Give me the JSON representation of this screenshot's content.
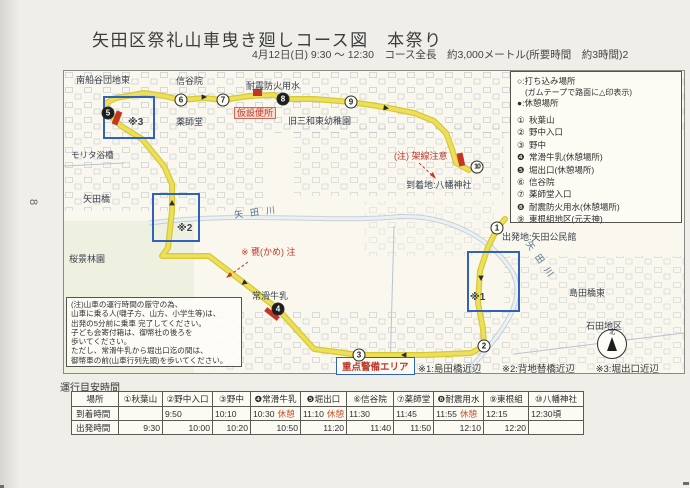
{
  "page": {
    "side_number": "8"
  },
  "header": {
    "title": "矢田区祭礼山車曳き廻しコース図　本祭り",
    "subtitle": "4月12日(日) 9:30 ～ 12:30　コース全長　約3,000メートル(所要時間　約3時間)2"
  },
  "legend": {
    "line1": "○:打ち込み場所",
    "line2": "(ガムテープで路面に△印表示)",
    "line3": "●:休憩場所",
    "items": [
      {
        "num": "①",
        "label": "秋葉山"
      },
      {
        "num": "②",
        "label": "野中入口"
      },
      {
        "num": "③",
        "label": "野中"
      },
      {
        "num": "❹",
        "label": "常滑牛乳(休憩場所)"
      },
      {
        "num": "❺",
        "label": "堀出口(休憩場所)"
      },
      {
        "num": "⑥",
        "label": "信谷院"
      },
      {
        "num": "⑦",
        "label": "薬師堂入口"
      },
      {
        "num": "❽",
        "label": "耐震防火用水(休憩場所)"
      },
      {
        "num": "⑨",
        "label": "東根組地区(元天神)"
      }
    ]
  },
  "map": {
    "labels": [
      "南船谷団地東",
      "信谷院",
      "耐震防火用水",
      "仮設便所",
      "旧三和東幼稚園",
      "薬師堂",
      "モリタ浴槽",
      "矢田橋",
      "桜景林園",
      "矢田川",
      "※ 甕(かめ) 注",
      "常滑牛乳",
      "(注) 架線注意",
      "到着地:八幡神社",
      "出発地:矢田公民館",
      "矢田川",
      "島田橋東",
      "石田地区",
      "※1",
      "※2",
      "※3"
    ],
    "points": [
      {
        "num": "1"
      },
      {
        "num": "2"
      },
      {
        "num": "3"
      },
      {
        "num": "4"
      },
      {
        "num": "5"
      },
      {
        "num": "6"
      },
      {
        "num": "7"
      },
      {
        "num": "8"
      },
      {
        "num": "9"
      },
      {
        "num": "10"
      }
    ],
    "note_lines": [
      "(注)山車の運行時間の厳守の為、",
      "山車に乗る人(囃子方、山方、小学生等)は、",
      "出発の5分前に乗車 完了してください。",
      "子ども会寄付箱は、御幣社の後ろを",
      "歩いてください。",
      "ただし、常滑牛乳から堀出口迄の間は、",
      "御幣車の前(山車行列先頭)を歩いてください。"
    ],
    "compass_north": "北"
  },
  "security": {
    "area_label": "重点警備エリア",
    "notes": [
      "※1:島田橋近辺",
      "※2:背地替橋近辺",
      "※3:堀出口近辺"
    ]
  },
  "schedule": {
    "title": "運行目安時間",
    "headers": [
      "場所",
      "①秋葉山",
      "②野中入口",
      "③野中",
      "❹常滑牛乳",
      "❺堀出口",
      "⑥信谷院",
      "⑦薬師堂",
      "❽耐震用水",
      "⑨東根組",
      "⑩八幡神社"
    ],
    "arrival_label": "到着時間",
    "departure_label": "出発時間",
    "arrival": [
      {
        "t": "",
        "b": ""
      },
      {
        "t": "9:50",
        "b": ""
      },
      {
        "t": "10:10",
        "b": ""
      },
      {
        "t": "10:30",
        "b": "休憩"
      },
      {
        "t": "11:10",
        "b": "休憩"
      },
      {
        "t": "11:30",
        "b": ""
      },
      {
        "t": "11:45",
        "b": ""
      },
      {
        "t": "11:55",
        "b": "休憩"
      },
      {
        "t": "12:15",
        "b": ""
      },
      {
        "t": "12:30頃",
        "b": ""
      }
    ],
    "departure": [
      "9:30",
      "10:00",
      "10:20",
      "10:50",
      "11:20",
      "11:40",
      "11:50",
      "12:10",
      "12:20",
      ""
    ]
  },
  "colors": {
    "route_yellow": "#e8d750",
    "warning_blue": "#2f62b8",
    "marker_red": "#c53524",
    "paper": "#efeee8"
  }
}
